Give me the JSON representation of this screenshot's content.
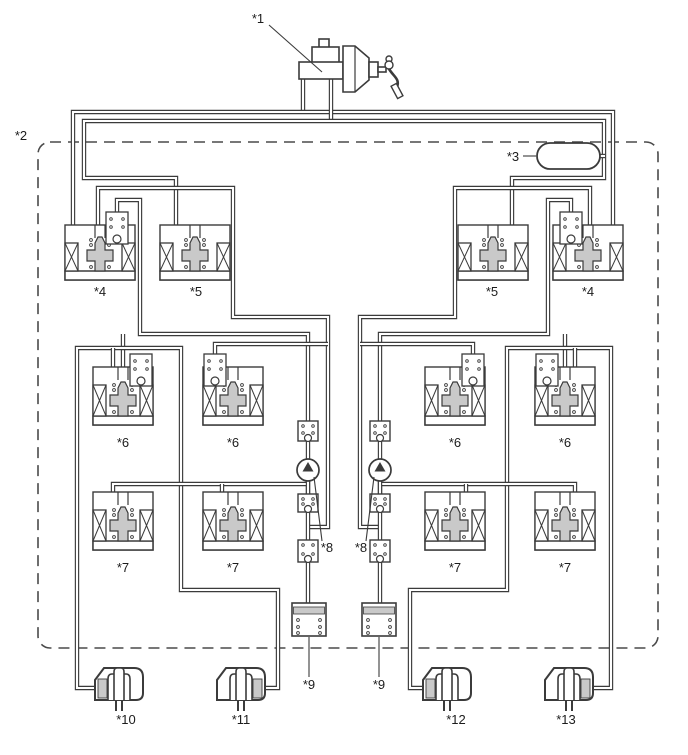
{
  "diagram": {
    "type": "brake-hydraulic-schematic",
    "canvas": {
      "width": 688,
      "height": 755
    },
    "colors": {
      "line": "#3b3b3b",
      "pipe_core": "#ffffff",
      "component_fill": "#ffffff",
      "gray_fill": "#c9c9c9",
      "dash": "#4a4a4a",
      "text": "#1c1c1c"
    },
    "boundary": {
      "x": 38,
      "y": 142,
      "w": 620,
      "h": 506,
      "rx": 12
    },
    "labels": [
      {
        "id": "label-1",
        "text": "*1",
        "x": 258,
        "y": 23,
        "leader": [
          [
            269,
            25
          ],
          [
            322,
            72
          ]
        ]
      },
      {
        "id": "label-2",
        "text": "*2",
        "x": 21,
        "y": 140
      },
      {
        "id": "label-3",
        "text": "*3",
        "x": 513,
        "y": 161,
        "leader": [
          [
            523,
            156
          ],
          [
            536,
            156
          ]
        ]
      },
      {
        "id": "label-4a",
        "text": "*4",
        "x": 100,
        "y": 296
      },
      {
        "id": "label-5a",
        "text": "*5",
        "x": 196,
        "y": 296
      },
      {
        "id": "label-5b",
        "text": "*5",
        "x": 492,
        "y": 296
      },
      {
        "id": "label-4b",
        "text": "*4",
        "x": 588,
        "y": 296
      },
      {
        "id": "label-6a",
        "text": "*6",
        "x": 123,
        "y": 447
      },
      {
        "id": "label-6b",
        "text": "*6",
        "x": 233,
        "y": 447
      },
      {
        "id": "label-6c",
        "text": "*6",
        "x": 455,
        "y": 447
      },
      {
        "id": "label-6d",
        "text": "*6",
        "x": 565,
        "y": 447
      },
      {
        "id": "label-7a",
        "text": "*7",
        "x": 123,
        "y": 572
      },
      {
        "id": "label-7b",
        "text": "*7",
        "x": 233,
        "y": 572
      },
      {
        "id": "label-7c",
        "text": "*7",
        "x": 455,
        "y": 572
      },
      {
        "id": "label-7d",
        "text": "*7",
        "x": 565,
        "y": 572
      },
      {
        "id": "label-8a",
        "text": "*8",
        "x": 327,
        "y": 552,
        "leader": [
          [
            314,
            477
          ],
          [
            322,
            541
          ]
        ]
      },
      {
        "id": "label-8b",
        "text": "*8",
        "x": 361,
        "y": 552,
        "leader": [
          [
            374,
            477
          ],
          [
            366,
            541
          ]
        ]
      },
      {
        "id": "label-9a",
        "text": "*9",
        "x": 309,
        "y": 689,
        "leader": [
          [
            309,
            637
          ],
          [
            309,
            677
          ]
        ]
      },
      {
        "id": "label-9b",
        "text": "*9",
        "x": 379,
        "y": 689,
        "leader": [
          [
            379,
            637
          ],
          [
            379,
            677
          ]
        ]
      },
      {
        "id": "label-10",
        "text": "*10",
        "x": 126,
        "y": 724
      },
      {
        "id": "label-11",
        "text": "*11",
        "x": 241,
        "y": 724
      },
      {
        "id": "label-12",
        "text": "*12",
        "x": 456,
        "y": 724
      },
      {
        "id": "label-13",
        "text": "*13",
        "x": 566,
        "y": 724
      }
    ],
    "pipes": [
      [
        [
          303,
          70
        ],
        [
          303,
          112
        ]
      ],
      [
        [
          73,
          226
        ],
        [
          73,
          112
        ],
        [
          613,
          112
        ],
        [
          613,
          226
        ]
      ],
      [
        [
          331,
          70
        ],
        [
          331,
          121
        ]
      ],
      [
        [
          176,
          226
        ],
        [
          176,
          178
        ],
        [
          84,
          178
        ],
        [
          84,
          121
        ],
        [
          604,
          121
        ],
        [
          604,
          178
        ],
        [
          512,
          178
        ],
        [
          512,
          226
        ]
      ],
      [
        [
          597,
          156
        ],
        [
          605,
          156
        ]
      ],
      [
        [
          98,
          226
        ],
        [
          98,
          188
        ],
        [
          233,
          188
        ],
        [
          233,
          317
        ],
        [
          328,
          317
        ],
        [
          328,
          527
        ],
        [
          308,
          527
        ]
      ],
      [
        [
          590,
          226
        ],
        [
          590,
          188
        ],
        [
          455,
          188
        ],
        [
          455,
          317
        ],
        [
          360,
          317
        ],
        [
          360,
          527
        ],
        [
          380,
          527
        ]
      ],
      [
        [
          117,
          213
        ],
        [
          117,
          200
        ],
        [
          140,
          200
        ],
        [
          140,
          334
        ],
        [
          308,
          334
        ],
        [
          308,
          421
        ]
      ],
      [
        [
          571,
          213
        ],
        [
          571,
          200
        ],
        [
          548,
          200
        ],
        [
          548,
          334
        ],
        [
          380,
          334
        ],
        [
          380,
          421
        ]
      ],
      [
        [
          123,
          369
        ],
        [
          123,
          334
        ]
      ],
      [
        [
          565,
          369
        ],
        [
          565,
          334
        ]
      ],
      [
        [
          96,
          688
        ],
        [
          77,
          688
        ],
        [
          77,
          348
        ],
        [
          181,
          348
        ],
        [
          181,
          590
        ],
        [
          278,
          590
        ],
        [
          278,
          688
        ],
        [
          264,
          688
        ]
      ],
      [
        [
          592,
          688
        ],
        [
          611,
          688
        ],
        [
          611,
          348
        ],
        [
          507,
          348
        ],
        [
          507,
          590
        ],
        [
          410,
          590
        ],
        [
          410,
          688
        ],
        [
          424,
          688
        ]
      ],
      [
        [
          113,
          369
        ],
        [
          113,
          348
        ]
      ],
      [
        [
          575,
          369
        ],
        [
          575,
          348
        ]
      ],
      [
        [
          215,
          357
        ],
        [
          215,
          344
        ],
        [
          328,
          344
        ]
      ],
      [
        [
          473,
          357
        ],
        [
          473,
          344
        ],
        [
          360,
          344
        ]
      ],
      [
        [
          113,
          493
        ],
        [
          113,
          484
        ],
        [
          308,
          484
        ],
        [
          308,
          494
        ]
      ],
      [
        [
          575,
          493
        ],
        [
          575,
          484
        ],
        [
          380,
          484
        ],
        [
          380,
          494
        ]
      ],
      [
        [
          222,
          493
        ],
        [
          222,
          484
        ]
      ],
      [
        [
          466,
          493
        ],
        [
          466,
          484
        ]
      ],
      [
        [
          308,
          441
        ],
        [
          308,
          459
        ]
      ],
      [
        [
          380,
          441
        ],
        [
          380,
          459
        ]
      ],
      [
        [
          308,
          481
        ],
        [
          308,
          494
        ]
      ],
      [
        [
          380,
          481
        ],
        [
          380,
          494
        ]
      ],
      [
        [
          308,
          512
        ],
        [
          308,
          540
        ]
      ],
      [
        [
          380,
          512
        ],
        [
          380,
          540
        ]
      ],
      [
        [
          308,
          562
        ],
        [
          308,
          603
        ]
      ],
      [
        [
          380,
          562
        ],
        [
          380,
          603
        ]
      ]
    ],
    "valves": [
      {
        "id": "solenoid-valve-4-left",
        "cx": 100,
        "y": 225,
        "w": 70,
        "h": 55,
        "check_cx": 117
      },
      {
        "id": "solenoid-valve-5-left",
        "cx": 195,
        "y": 225,
        "w": 70,
        "h": 55,
        "check_cx": null
      },
      {
        "id": "solenoid-valve-5-right",
        "cx": 493,
        "y": 225,
        "w": 70,
        "h": 55,
        "check_cx": null
      },
      {
        "id": "solenoid-valve-4-right",
        "cx": 588,
        "y": 225,
        "w": 70,
        "h": 55,
        "check_cx": 571
      },
      {
        "id": "solenoid-valve-6-left-outer",
        "cx": 123,
        "y": 367,
        "w": 60,
        "h": 58,
        "check_cx": 141
      },
      {
        "id": "solenoid-valve-6-left-inner",
        "cx": 233,
        "y": 367,
        "w": 60,
        "h": 58,
        "check_cx": 215
      },
      {
        "id": "solenoid-valve-6-right-inner",
        "cx": 455,
        "y": 367,
        "w": 60,
        "h": 58,
        "check_cx": 473
      },
      {
        "id": "solenoid-valve-6-right-outer",
        "cx": 565,
        "y": 367,
        "w": 60,
        "h": 58,
        "check_cx": 547
      },
      {
        "id": "solenoid-valve-7-left-outer",
        "cx": 123,
        "y": 492,
        "w": 60,
        "h": 58,
        "check_cx": null
      },
      {
        "id": "solenoid-valve-7-left-inner",
        "cx": 233,
        "y": 492,
        "w": 60,
        "h": 58,
        "check_cx": null
      },
      {
        "id": "solenoid-valve-7-right-inner",
        "cx": 455,
        "y": 492,
        "w": 60,
        "h": 58,
        "check_cx": null
      },
      {
        "id": "solenoid-valve-7-right-outer",
        "cx": 565,
        "y": 492,
        "w": 60,
        "h": 58,
        "check_cx": null
      }
    ],
    "pumps": [
      {
        "id": "pump-left",
        "cx": 308,
        "cy": 470,
        "r": 11
      },
      {
        "id": "pump-right",
        "cx": 380,
        "cy": 470,
        "r": 11
      }
    ],
    "check_valves": [
      {
        "id": "check-valve-left-top",
        "cx": 308,
        "y": 421,
        "h": 20
      },
      {
        "id": "check-valve-left-mid",
        "cx": 308,
        "y": 494,
        "h": 18
      },
      {
        "id": "check-valve-left-bottom",
        "cx": 308,
        "y": 540,
        "h": 22
      },
      {
        "id": "check-valve-right-top",
        "cx": 380,
        "y": 421,
        "h": 20
      },
      {
        "id": "check-valve-right-mid",
        "cx": 380,
        "y": 494,
        "h": 18
      },
      {
        "id": "check-valve-right-bottom",
        "cx": 380,
        "y": 540,
        "h": 22
      }
    ],
    "reservoirs": [
      {
        "id": "reservoir-left",
        "x": 292,
        "y": 603,
        "w": 34,
        "h": 33
      },
      {
        "id": "reservoir-right",
        "x": 362,
        "y": 603,
        "w": 34,
        "h": 33
      }
    ],
    "wheel_cylinders": [
      {
        "id": "wheel-cylinder-10",
        "x": 95,
        "y": 668,
        "w": 48,
        "h": 32,
        "feed": "left"
      },
      {
        "id": "wheel-cylinder-11",
        "x": 217,
        "y": 668,
        "w": 48,
        "h": 32,
        "feed": "right"
      },
      {
        "id": "wheel-cylinder-12",
        "x": 423,
        "y": 668,
        "w": 48,
        "h": 32,
        "feed": "left"
      },
      {
        "id": "wheel-cylinder-13",
        "x": 545,
        "y": 668,
        "w": 48,
        "h": 32,
        "feed": "right"
      }
    ],
    "accumulator": {
      "id": "accumulator",
      "x": 537,
      "y": 143,
      "w": 63,
      "h": 26
    },
    "master_cylinder": {
      "id": "master-cylinder-and-booster",
      "present": true
    }
  }
}
